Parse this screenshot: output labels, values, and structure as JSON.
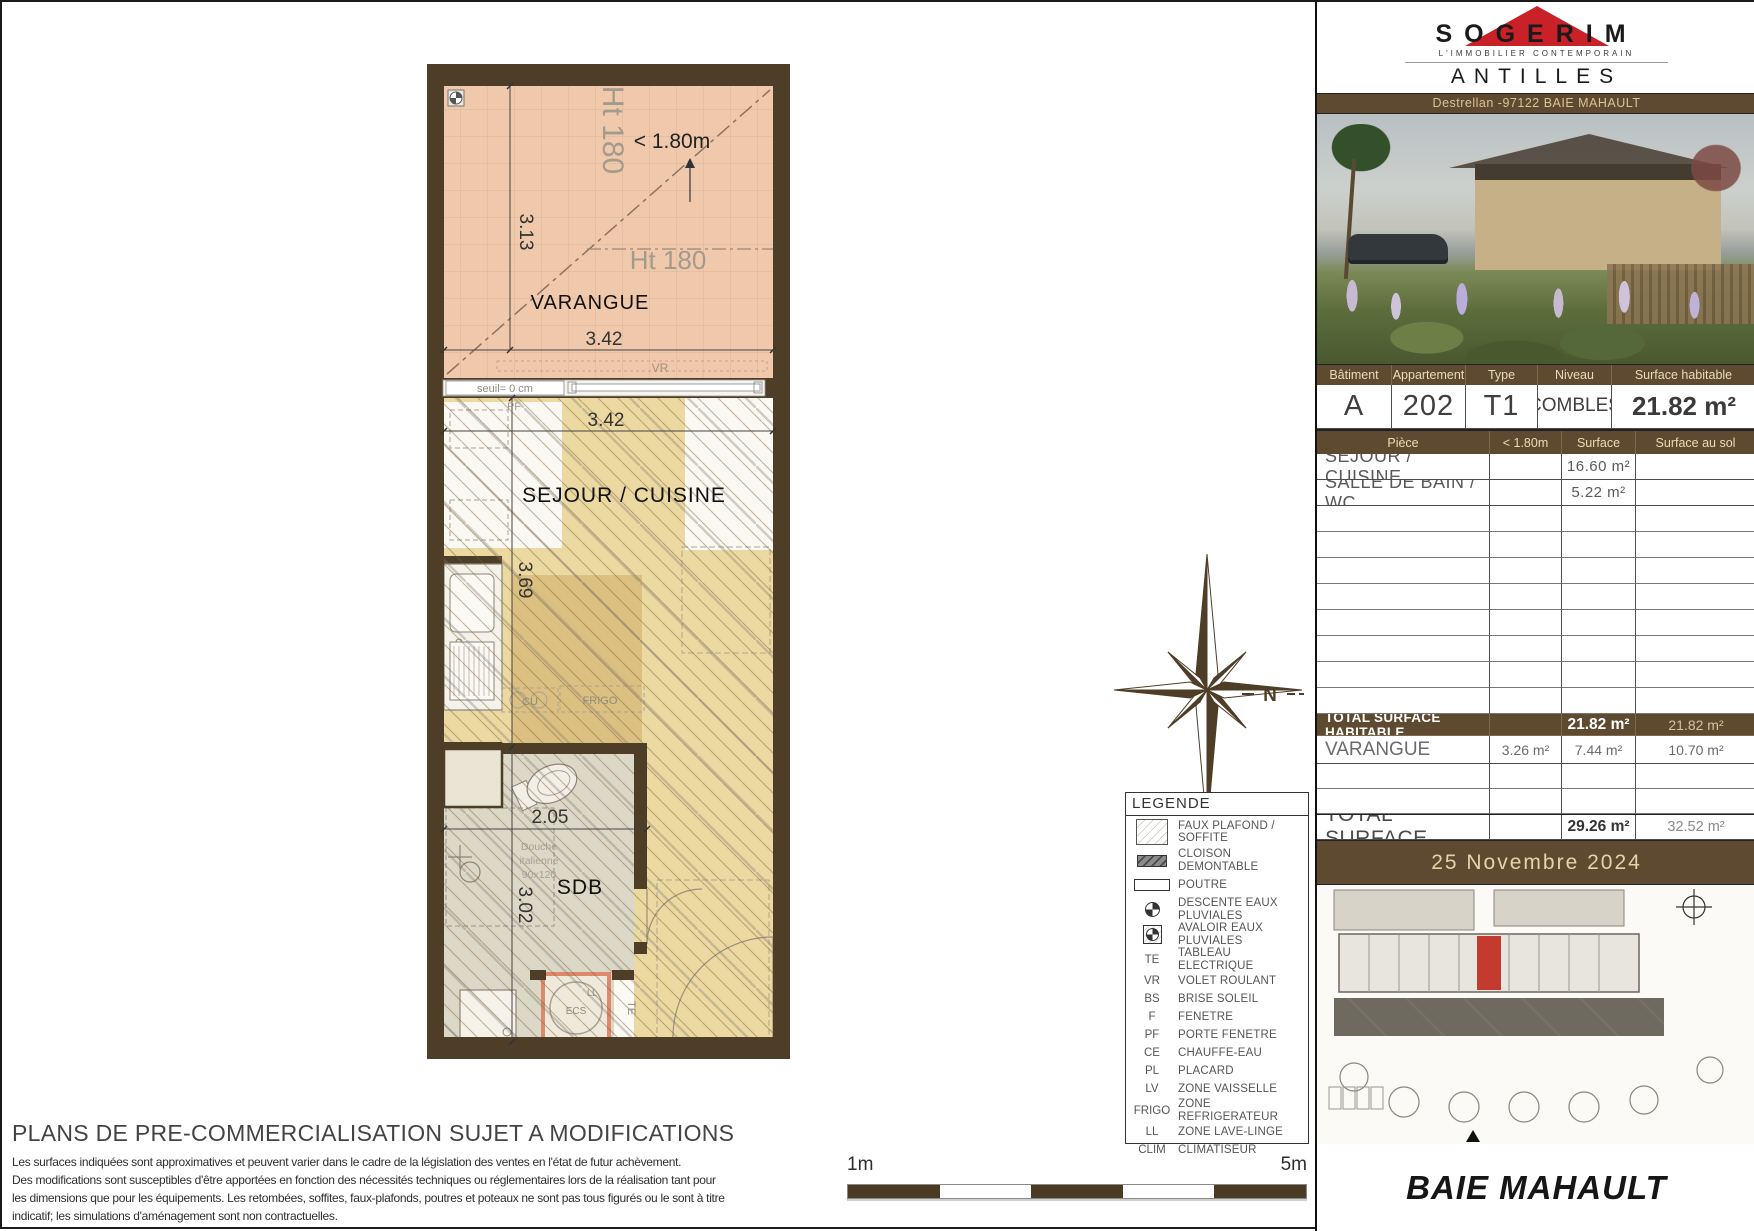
{
  "header": {
    "brand": "SOGERIM",
    "tagline": "L'IMMOBILIER CONTEMPORAIN",
    "region": "ANTILLES",
    "address": "Destrellan -97122 BAIE MAHAULT"
  },
  "info_table": {
    "headers": [
      "Bâtiment",
      "Appartement",
      "Type",
      "Niveau",
      "Surface habitable"
    ],
    "values": [
      "A",
      "202",
      "T1",
      "COMBLES",
      "21.82 m²"
    ]
  },
  "rooms_table": {
    "headers": [
      "Pièce",
      "< 1.80m",
      "Surface",
      "Surface au sol"
    ],
    "rows": [
      {
        "piece": "SEJOUR / CUISINE",
        "lt180": "",
        "surface": "16.60 m²",
        "sol": ""
      },
      {
        "piece": "SALLE DE BAIN / WC",
        "lt180": "",
        "surface": "5.22 m²",
        "sol": ""
      }
    ],
    "total_habitable": {
      "label": "TOTAL SURFACE HABITABLE",
      "lt180": "",
      "surface": "21.82 m²",
      "sol": "21.82 m²"
    },
    "varangue": {
      "label": "VARANGUE",
      "lt180": "3.26 m²",
      "surface": "7.44 m²",
      "sol": "10.70 m²"
    },
    "total": {
      "label": "TOTAL SURFACE",
      "lt180": "",
      "surface": "29.26 m²",
      "sol": "32.52 m²"
    }
  },
  "date": "25 Novembre 2024",
  "city": "BAIE MAHAULT",
  "legend": {
    "title": "LEGENDE",
    "items": [
      {
        "abbr": "",
        "label": "FAUX PLAFOND / SOFFITE"
      },
      {
        "abbr": "",
        "label": "CLOISON DEMONTABLE"
      },
      {
        "abbr": "",
        "label": "POUTRE"
      },
      {
        "abbr": "",
        "label": "DESCENTE EAUX PLUVIALES"
      },
      {
        "abbr": "",
        "label": "AVALOIR EAUX PLUVIALES"
      },
      {
        "abbr": "TE",
        "label": "TABLEAU ELECTRIQUE"
      },
      {
        "abbr": "VR",
        "label": "VOLET ROULANT"
      },
      {
        "abbr": "BS",
        "label": "BRISE SOLEIL"
      },
      {
        "abbr": "F",
        "label": "FENETRE"
      },
      {
        "abbr": "PF",
        "label": "PORTE FENETRE"
      },
      {
        "abbr": "CE",
        "label": "CHAUFFE-EAU"
      },
      {
        "abbr": "PL",
        "label": "PLACARD"
      },
      {
        "abbr": "LV",
        "label": "ZONE VAISSELLE"
      },
      {
        "abbr": "FRIGO",
        "label": "ZONE REFRIGERATEUR"
      },
      {
        "abbr": "LL",
        "label": "ZONE LAVE-LINGE"
      },
      {
        "abbr": "CLIM",
        "label": "CLIMATISEUR"
      }
    ]
  },
  "plan": {
    "rooms": {
      "varangue": "VARANGUE",
      "sejour": "SEJOUR / CUISINE",
      "sdb": "SDB"
    },
    "dims": {
      "d313": "3.13",
      "d342a": "3.42",
      "d342b": "3.42",
      "d369": "3.69",
      "d205": "2.05",
      "d302": "3.02"
    },
    "annotations": {
      "ht180_v": "Ht 180",
      "ht180_h": "Ht 180",
      "lt180": "< 1.80m",
      "seuil": "seuil= 0 cm",
      "vr": "VR",
      "pf": "PF",
      "cu": "CU",
      "frigo": "FRIGO",
      "douche1": "Douche",
      "douche2": "italienne",
      "douche3": "90x120",
      "ll": "LL",
      "ecs": "ECS",
      "te": "TE",
      "north": "N"
    }
  },
  "footer": {
    "disclaimer_title": "PLANS DE PRE-COMMERCIALISATION SUJET A MODIFICATIONS",
    "disclaimer_lines": [
      "Les surfaces indiquées sont approximatives et peuvent varier dans le cadre de la législation des ventes en l'état de futur achèvement.",
      "Des modifications sont susceptibles d'être apportées en fonction des nécessités techniques ou réglementaires lors de la réalisation tant pour",
      "les dimensions que pour les équipements. Les retombées, soffites, faux-plafonds, poutres et poteaux ne sont pas tous figurés ou le sont à titre",
      "indicatif; les simulations d'aménagement sont non contractuelles."
    ],
    "scale_min": "1m",
    "scale_max": "5m"
  },
  "colors": {
    "brand_red": "#c92128",
    "panel_brown": "#5d4a31",
    "wall_brown": "#4e3d27",
    "varangue_pink": "#f0c9ac",
    "floor_tan": "#ecd9a2",
    "bath_grey": "#dcd8c8",
    "ecs_accent": "#e0886b"
  }
}
